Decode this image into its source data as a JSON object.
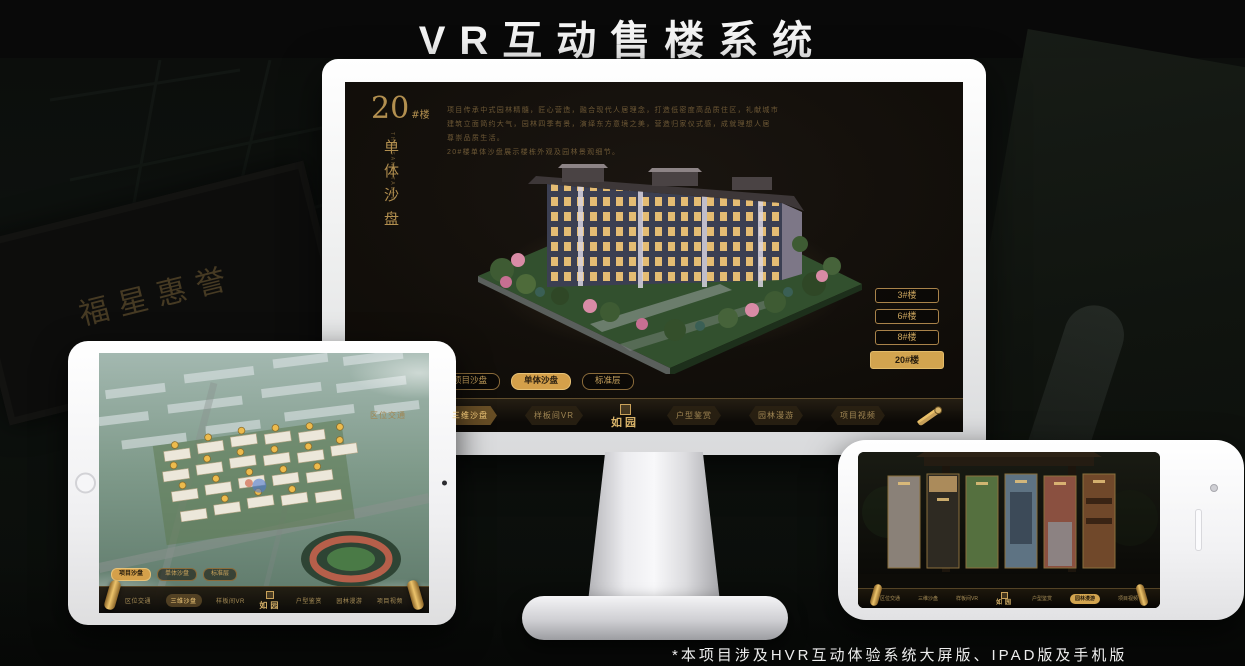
{
  "page": {
    "title": "VR互动售楼系统",
    "footnote": "*本项目涉及HVR互动体验系统大屏版、IPAD版及手机版"
  },
  "colors": {
    "gold": "#c8a35a",
    "gold_bright": "#e9c375",
    "gold_dim": "#8a6f45",
    "screen_bg": "#13100b",
    "selected_fill": "#d2a44f"
  },
  "brand": {
    "logo": "如园"
  },
  "background": {
    "plaque_text": "福星惠誉"
  },
  "monitor": {
    "block_number": "20",
    "block_suffix": "#楼",
    "vertical_title": "单体沙盘",
    "vertical_subtitle": "THE SAND TABLE",
    "intro_lines": [
      "项目传承中式园林精髓，匠心营造，融合现代人居理念，打造低密度高品质住区，礼献城市",
      "建筑立面简约大气，园林四季有景，演绎东方意境之美，营造归家仪式感，成就理想人居",
      "尊崇品质生活。",
      "20#楼单体沙盘展示楼栋外观及园林景观细节。"
    ],
    "floor_buttons": [
      {
        "label": "3#楼",
        "selected": false
      },
      {
        "label": "6#楼",
        "selected": false
      },
      {
        "label": "8#楼",
        "selected": false
      },
      {
        "label": "20#楼",
        "selected": true
      }
    ],
    "tabs": [
      {
        "label": "项目沙盘",
        "selected": false
      },
      {
        "label": "单体沙盘",
        "selected": true
      },
      {
        "label": "标准层",
        "selected": false
      }
    ],
    "nav_items": [
      {
        "label": "区位交通",
        "active": false
      },
      {
        "label": "三维沙盘",
        "active": true
      },
      {
        "label": "样板间VR",
        "active": false
      },
      {
        "label": "户型鉴赏",
        "active": false
      },
      {
        "label": "园林漫游",
        "active": false
      },
      {
        "label": "项目视频",
        "active": false
      }
    ]
  },
  "tablet": {
    "tabs": [
      {
        "label": "项目沙盘",
        "selected": true
      },
      {
        "label": "单体沙盘",
        "selected": false
      },
      {
        "label": "标准层",
        "selected": false
      }
    ],
    "nav_items": [
      {
        "label": "区位交通",
        "active": false
      },
      {
        "label": "三维沙盘",
        "active": true
      },
      {
        "label": "样板间VR",
        "active": false
      },
      {
        "label": "户型鉴赏",
        "active": false
      },
      {
        "label": "园林漫游",
        "active": false
      },
      {
        "label": "项目视频",
        "active": false
      }
    ]
  },
  "phone": {
    "nav_items": [
      {
        "label": "区位交通",
        "active": false
      },
      {
        "label": "三维沙盘",
        "active": false
      },
      {
        "label": "样板间VR",
        "active": false
      },
      {
        "label": "户型鉴赏",
        "active": false
      },
      {
        "label": "园林漫游",
        "active": true
      },
      {
        "label": "项目视频",
        "active": false
      }
    ]
  }
}
